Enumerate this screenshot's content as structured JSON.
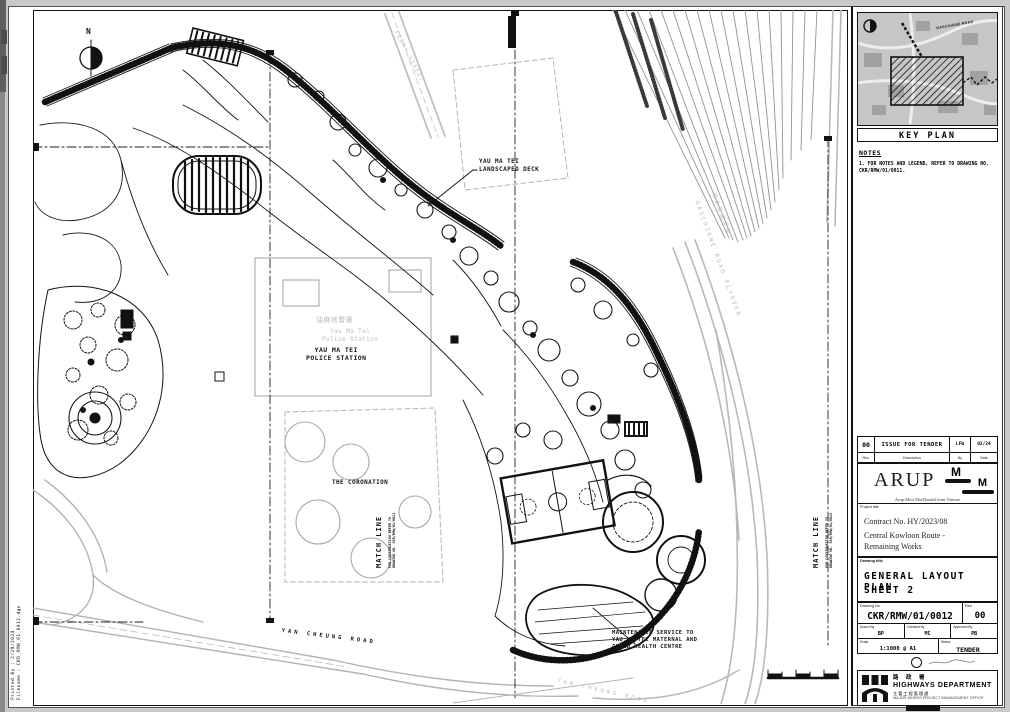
{
  "colors": {
    "ink": "#1a1a1a",
    "faint_map": "#bcbcbc",
    "sheet": "#ffffff",
    "page": "#c9c9c9"
  },
  "plan": {
    "north": "N",
    "labels": {
      "deck": "YAU MA TEI\nLANDSCAPED DECK",
      "police_chinese": "油麻地警署",
      "police_map": "Yau Ma Tei\nPolice Station",
      "police": "YAU MA TEI\nPOLICE STATION",
      "coronation": "THE CORONATION",
      "match_line_left": "MATCH LINE",
      "match_line_left_note": "FOR CONTINUATION REFER TO\nDRAWING NO. CKR/RMW/01/0011",
      "match_line_right": "MATCH LINE",
      "match_line_right_note": "FOR CONTINUATION REFER TO\nDRAWING NO. CKR/RMW/01/0013",
      "yan_cheung_road": "YAN CHEUNG ROAD",
      "yan_cheung_road_map": "YAN CHEUNG ROAD",
      "maintenance_note": "MAINTENANCE SERVICE TO\nYAU MA TEI MATERNAL AND\nCHILD HEALTH CENTRE",
      "gascoigne_chinese": "加士居道天橋",
      "gascoigne": "GASCOIGNE ROAD FLYOVER",
      "ferry_street": "FERRY STREET"
    }
  },
  "edge": {
    "printed_by": "Printed By : 2/29/2024",
    "filename": "Filename : CKR_RMW_01_0012.dgn"
  },
  "titleblock": {
    "keyplan": {
      "caption": "KEY PLAN",
      "road_label": "GASCOIGNE ROAD"
    },
    "notes": {
      "heading": "NOTES",
      "item1": "1. FOR NOTES AND LEGEND, REFER TO DRAWING NO.\n    CKR/RMW/01/0011."
    },
    "revision": {
      "rev": "00",
      "description": "ISSUE FOR TENDER",
      "by": "LFW",
      "date": "02/24",
      "headers": {
        "rev": "Rev.",
        "description": "Description",
        "by": "By",
        "date": "Date"
      }
    },
    "firm": {
      "name": "ARUP",
      "partner_initial_1": "M",
      "partner_initial_2": "M",
      "jv": "Arup-Mott MacDonald Joint Venture"
    },
    "project": {
      "label": "Project title",
      "line1": "Contract No. HY/2023/08",
      "line2": "Central Kowloon Route -",
      "line3": "Remaining Works"
    },
    "drawing": {
      "label": "Drawing title",
      "line1": "GENERAL LAYOUT PLAN",
      "line2": "SHEET 2"
    },
    "number": {
      "label": "Drawing No.",
      "value": "CKR/RMW/01/0012",
      "rev_label": "Rev.",
      "rev": "00"
    },
    "signatures": {
      "drawn_label": "Drawn By",
      "drawn": "BP",
      "checked_label": "Checked By",
      "checked": "MC",
      "approved_label": "Approved By",
      "approved": "PB"
    },
    "scale": {
      "label": "Scale",
      "value": "1:1000 @ A1",
      "status_label": "Status",
      "status": "TENDER"
    },
    "department": {
      "chinese": "路 政 署",
      "name": "HIGHWAYS DEPARTMENT",
      "office_chinese": "主要工程管理處",
      "office": "MAJOR WORKS PROJECT MANAGEMENT OFFICE"
    }
  }
}
